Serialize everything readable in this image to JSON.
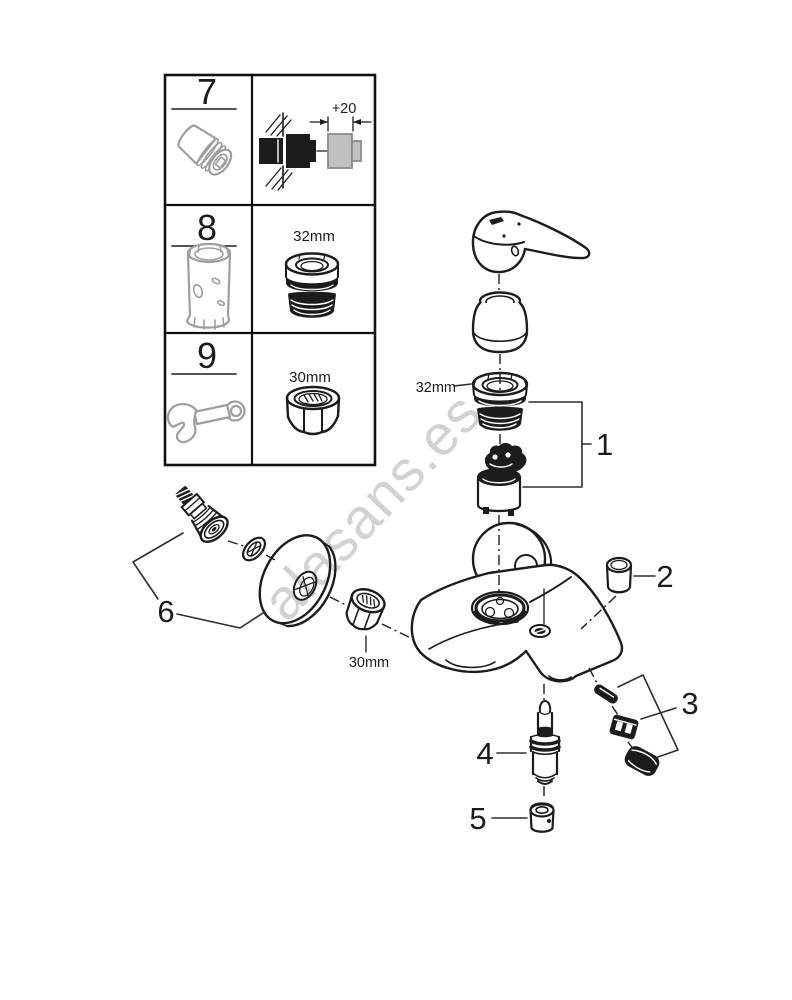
{
  "watermark": {
    "text": "alasans.es"
  },
  "colors": {
    "line": "#1c1c1c",
    "grey_part": "#9e9e9e",
    "grey_fill": "#c0c0c0",
    "watermark": "#d2d2d2",
    "background": "#ffffff"
  },
  "legend_table": {
    "rows": [
      {
        "number": "7",
        "dimension": "+20"
      },
      {
        "number": "8",
        "dimension": "32mm"
      },
      {
        "number": "9",
        "dimension": "30mm"
      }
    ]
  },
  "exploded_view": {
    "callouts": [
      "1",
      "2",
      "3",
      "4",
      "5",
      "6"
    ],
    "dim_ring": "32mm",
    "dim_nut": "30mm"
  }
}
